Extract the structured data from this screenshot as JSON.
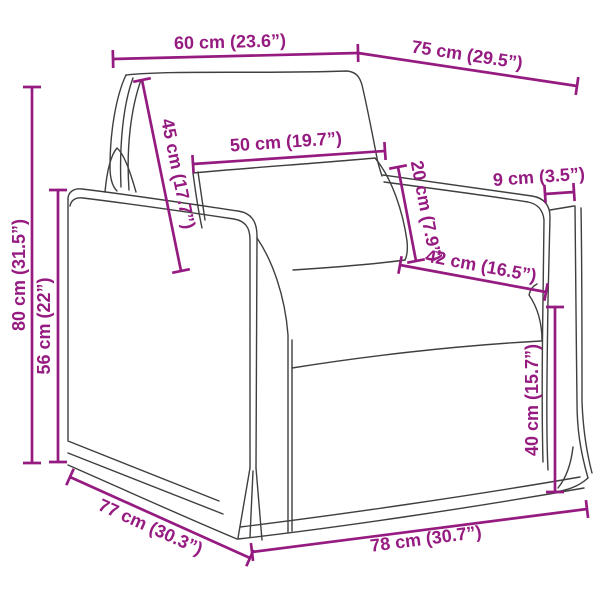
{
  "diagram": {
    "type": "product-dimension-diagram",
    "subject": "armchair line drawing",
    "background_color": "#ffffff",
    "art_color": "#3f3f3e",
    "dimension_color": "#951b81",
    "dimensions": {
      "top_width": {
        "label": "60 cm (23.6”)",
        "cm": 60,
        "inches": 23.6
      },
      "top_depth": {
        "label": "75 cm (29.5”)",
        "cm": 75,
        "inches": 29.5
      },
      "back_cushion": {
        "label": "45 cm (17.7”)",
        "cm": 45,
        "inches": 17.7
      },
      "pillow_width": {
        "label": "50 cm (19.7”)",
        "cm": 50,
        "inches": 19.7
      },
      "pillow_thickness": {
        "label": "20 cm (7.9”)",
        "cm": 20,
        "inches": 7.9
      },
      "arm_width": {
        "label": "9 cm (3.5”)",
        "cm": 9,
        "inches": 3.5
      },
      "seat_width": {
        "label": "42 cm (16.5”)",
        "cm": 42,
        "inches": 16.5
      },
      "seat_height": {
        "label": "40 cm (15.7”)",
        "cm": 40,
        "inches": 15.7
      },
      "overall_height": {
        "label": "80 cm (31.5”)",
        "cm": 80,
        "inches": 31.5
      },
      "arm_height": {
        "label": "56 cm (22”)",
        "cm": 56,
        "inches": 22
      },
      "base_depth": {
        "label": "77 cm (30.3”)",
        "cm": 77,
        "inches": 30.3
      },
      "base_width": {
        "label": "78 cm (30.7”)",
        "cm": 78,
        "inches": 30.7
      }
    }
  }
}
